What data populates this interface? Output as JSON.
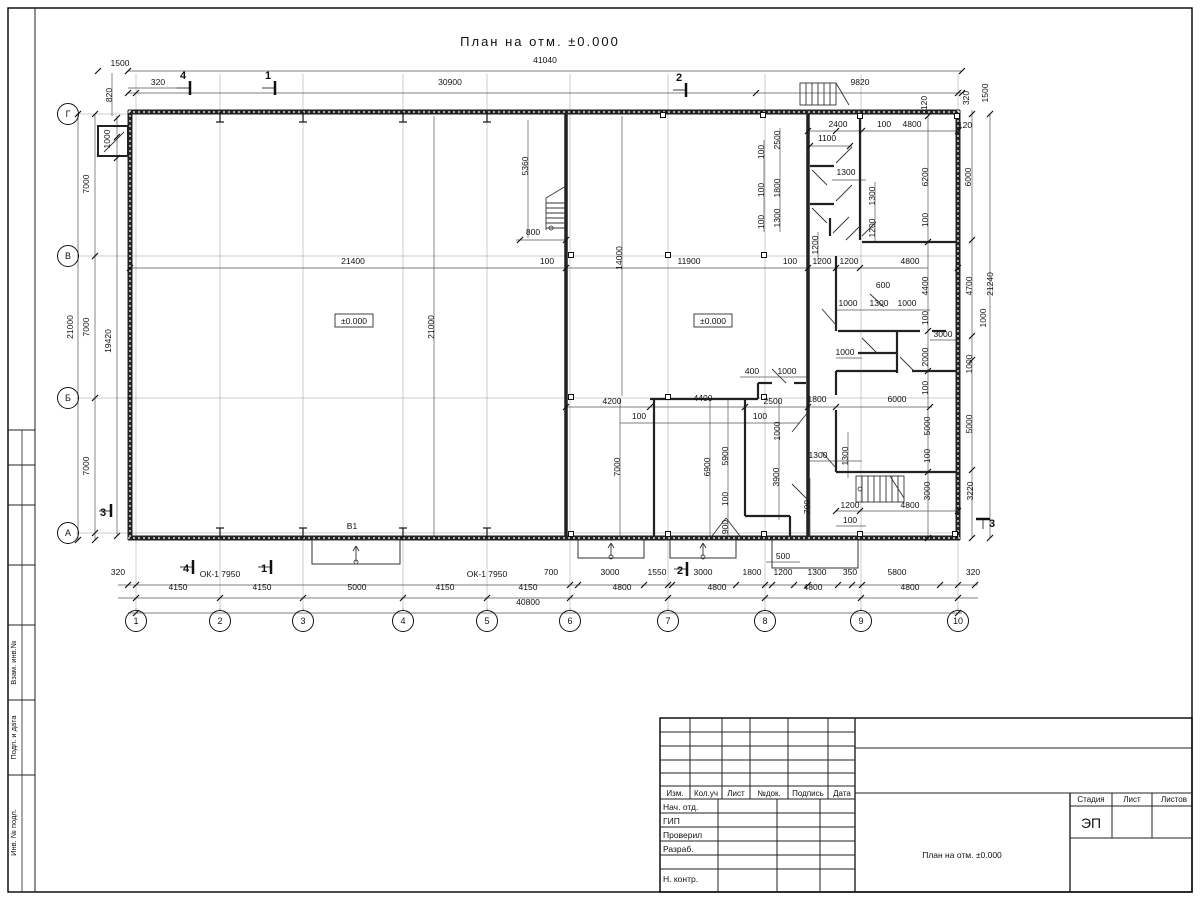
{
  "sheet": {
    "title": "План на отм. ±0.000"
  },
  "level_marks": [
    {
      "t": "±0.000",
      "x": 354,
      "y": 324
    },
    {
      "t": "±0.000",
      "x": 713,
      "y": 324
    }
  ],
  "labels": [
    {
      "t": "В1",
      "x": 352,
      "y": 529
    },
    {
      "t": "ОК-1 7950",
      "x": 220,
      "y": 577
    },
    {
      "t": "ОК-1 7950",
      "x": 487,
      "y": 577
    }
  ],
  "section_marks": [
    {
      "t": "4",
      "x": 183,
      "y": 79,
      "o": "t"
    },
    {
      "t": "1",
      "x": 268,
      "y": 79,
      "o": "t"
    },
    {
      "t": "2",
      "x": 679,
      "y": 81,
      "o": "t"
    },
    {
      "t": "4",
      "x": 186,
      "y": 572,
      "o": "b"
    },
    {
      "t": "1",
      "x": 264,
      "y": 572,
      "o": "b"
    },
    {
      "t": "2",
      "x": 680,
      "y": 574,
      "o": "b"
    },
    {
      "t": "3",
      "x": 103,
      "y": 516,
      "o": "l"
    },
    {
      "t": "3",
      "x": 992,
      "y": 527,
      "o": "r"
    }
  ],
  "grid": {
    "columns": [
      {
        "label": "1",
        "x": 136
      },
      {
        "label": "2",
        "x": 220
      },
      {
        "label": "3",
        "x": 303
      },
      {
        "label": "4",
        "x": 403
      },
      {
        "label": "5",
        "x": 487
      },
      {
        "label": "6",
        "x": 570
      },
      {
        "label": "7",
        "x": 668
      },
      {
        "label": "8",
        "x": 765
      },
      {
        "label": "9",
        "x": 861
      },
      {
        "label": "10",
        "x": 958
      }
    ],
    "bubble_y": 621,
    "rows": [
      {
        "label": "Г",
        "y": 114
      },
      {
        "label": "В",
        "y": 256
      },
      {
        "label": "Б",
        "y": 398
      },
      {
        "label": "А",
        "y": 533
      }
    ],
    "bubble_x": 68
  },
  "dims": [
    {
      "t": "41040",
      "x": 545,
      "y": 63
    },
    {
      "t": "30900",
      "x": 450,
      "y": 85
    },
    {
      "t": "9820",
      "x": 860,
      "y": 85
    },
    {
      "t": "1500",
      "x": 120,
      "y": 66
    },
    {
      "t": "320",
      "x": 158,
      "y": 85
    },
    {
      "t": "820",
      "x": 112,
      "y": 95,
      "v": 1
    },
    {
      "t": "120",
      "x": 927,
      "y": 103,
      "v": 1
    },
    {
      "t": "320",
      "x": 969,
      "y": 98,
      "v": 1
    },
    {
      "t": "1500",
      "x": 988,
      "y": 93,
      "v": 1
    },
    {
      "t": "1000",
      "x": 110,
      "y": 139,
      "v": 1
    },
    {
      "t": "7000",
      "x": 89,
      "y": 184,
      "v": 1
    },
    {
      "t": "7000",
      "x": 89,
      "y": 327,
      "v": 1
    },
    {
      "t": "7000",
      "x": 89,
      "y": 466,
      "v": 1
    },
    {
      "t": "21000",
      "x": 73,
      "y": 327,
      "v": 1
    },
    {
      "t": "19420",
      "x": 111,
      "y": 341,
      "v": 1
    },
    {
      "t": "21400",
      "x": 353,
      "y": 264
    },
    {
      "t": "100",
      "x": 547,
      "y": 264
    },
    {
      "t": "11900",
      "x": 689,
      "y": 264
    },
    {
      "t": "100",
      "x": 790,
      "y": 264
    },
    {
      "t": "1200",
      "x": 822,
      "y": 264
    },
    {
      "t": "1200",
      "x": 849,
      "y": 264
    },
    {
      "t": "4800",
      "x": 910,
      "y": 264
    },
    {
      "t": "800",
      "x": 533,
      "y": 235
    },
    {
      "t": "5360",
      "x": 528,
      "y": 166,
      "v": 1
    },
    {
      "t": "21000",
      "x": 434,
      "y": 327,
      "v": 1
    },
    {
      "t": "14000",
      "x": 622,
      "y": 258,
      "v": 1
    },
    {
      "t": "2400",
      "x": 838,
      "y": 127
    },
    {
      "t": "100",
      "x": 884,
      "y": 127
    },
    {
      "t": "4800",
      "x": 912,
      "y": 127
    },
    {
      "t": "120",
      "x": 965,
      "y": 128
    },
    {
      "t": "1100",
      "x": 827,
      "y": 141
    },
    {
      "t": "2500",
      "x": 780,
      "y": 140,
      "v": 1
    },
    {
      "t": "100",
      "x": 764,
      "y": 152,
      "v": 1
    },
    {
      "t": "1800",
      "x": 780,
      "y": 188,
      "v": 1
    },
    {
      "t": "100",
      "x": 764,
      "y": 190,
      "v": 1
    },
    {
      "t": "1300",
      "x": 780,
      "y": 218,
      "v": 1
    },
    {
      "t": "100",
      "x": 764,
      "y": 222,
      "v": 1
    },
    {
      "t": "1300",
      "x": 846,
      "y": 175
    },
    {
      "t": "1300",
      "x": 875,
      "y": 196,
      "v": 1
    },
    {
      "t": "1200",
      "x": 875,
      "y": 228,
      "v": 1
    },
    {
      "t": "1200",
      "x": 818,
      "y": 245,
      "v": 1
    },
    {
      "t": "6200",
      "x": 928,
      "y": 177,
      "v": 1
    },
    {
      "t": "6000",
      "x": 971,
      "y": 177,
      "v": 1
    },
    {
      "t": "100",
      "x": 928,
      "y": 220,
      "v": 1
    },
    {
      "t": "600",
      "x": 883,
      "y": 288
    },
    {
      "t": "1000",
      "x": 848,
      "y": 306
    },
    {
      "t": "1300",
      "x": 879,
      "y": 306
    },
    {
      "t": "1000",
      "x": 907,
      "y": 306
    },
    {
      "t": "100",
      "x": 928,
      "y": 318,
      "v": 1
    },
    {
      "t": "1000",
      "x": 986,
      "y": 318,
      "v": 1
    },
    {
      "t": "4400",
      "x": 928,
      "y": 286,
      "v": 1
    },
    {
      "t": "4700",
      "x": 972,
      "y": 286,
      "v": 1
    },
    {
      "t": "21240",
      "x": 993,
      "y": 284,
      "v": 1
    },
    {
      "t": "3000",
      "x": 943,
      "y": 337
    },
    {
      "t": "2000",
      "x": 928,
      "y": 357,
      "v": 1
    },
    {
      "t": "1000",
      "x": 845,
      "y": 355
    },
    {
      "t": "1000",
      "x": 972,
      "y": 364,
      "v": 1
    },
    {
      "t": "100",
      "x": 928,
      "y": 388,
      "v": 1
    },
    {
      "t": "400",
      "x": 752,
      "y": 374
    },
    {
      "t": "1000",
      "x": 787,
      "y": 374
    },
    {
      "t": "4200",
      "x": 612,
      "y": 404
    },
    {
      "t": "4400",
      "x": 703,
      "y": 401
    },
    {
      "t": "2500",
      "x": 773,
      "y": 404
    },
    {
      "t": "1800",
      "x": 817,
      "y": 402
    },
    {
      "t": "6000",
      "x": 897,
      "y": 402
    },
    {
      "t": "100",
      "x": 639,
      "y": 419
    },
    {
      "t": "100",
      "x": 760,
      "y": 419
    },
    {
      "t": "1000",
      "x": 780,
      "y": 431,
      "v": 1
    },
    {
      "t": "7000",
      "x": 620,
      "y": 467,
      "v": 1
    },
    {
      "t": "6900",
      "x": 710,
      "y": 467,
      "v": 1
    },
    {
      "t": "5900",
      "x": 728,
      "y": 456,
      "v": 1
    },
    {
      "t": "3900",
      "x": 779,
      "y": 477,
      "v": 1
    },
    {
      "t": "5000",
      "x": 930,
      "y": 426,
      "v": 1
    },
    {
      "t": "5000",
      "x": 972,
      "y": 424,
      "v": 1
    },
    {
      "t": "1300",
      "x": 818,
      "y": 458
    },
    {
      "t": "1300",
      "x": 848,
      "y": 456,
      "v": 1
    },
    {
      "t": "100",
      "x": 930,
      "y": 456,
      "v": 1
    },
    {
      "t": "700",
      "x": 810,
      "y": 507,
      "v": 1
    },
    {
      "t": "100",
      "x": 728,
      "y": 499,
      "v": 1
    },
    {
      "t": "900",
      "x": 728,
      "y": 527,
      "v": 1
    },
    {
      "t": "3000",
      "x": 930,
      "y": 491,
      "v": 1
    },
    {
      "t": "3220",
      "x": 973,
      "y": 491,
      "v": 1
    },
    {
      "t": "1200",
      "x": 850,
      "y": 508
    },
    {
      "t": "4800",
      "x": 910,
      "y": 508
    },
    {
      "t": "100",
      "x": 850,
      "y": 523
    },
    {
      "t": "500",
      "x": 783,
      "y": 559
    },
    {
      "t": "320",
      "x": 118,
      "y": 575
    },
    {
      "t": "700",
      "x": 551,
      "y": 575
    },
    {
      "t": "3000",
      "x": 610,
      "y": 575
    },
    {
      "t": "1550",
      "x": 657,
      "y": 575
    },
    {
      "t": "3000",
      "x": 703,
      "y": 575
    },
    {
      "t": "1800",
      "x": 752,
      "y": 575
    },
    {
      "t": "1200",
      "x": 783,
      "y": 575
    },
    {
      "t": "1300",
      "x": 817,
      "y": 575
    },
    {
      "t": "350",
      "x": 850,
      "y": 575
    },
    {
      "t": "5800",
      "x": 897,
      "y": 575
    },
    {
      "t": "320",
      "x": 973,
      "y": 575
    },
    {
      "t": "4150",
      "x": 178,
      "y": 590
    },
    {
      "t": "4150",
      "x": 262,
      "y": 590
    },
    {
      "t": "5000",
      "x": 357,
      "y": 590
    },
    {
      "t": "4150",
      "x": 445,
      "y": 590
    },
    {
      "t": "4150",
      "x": 528,
      "y": 590
    },
    {
      "t": "4800",
      "x": 622,
      "y": 590
    },
    {
      "t": "4800",
      "x": 717,
      "y": 590
    },
    {
      "t": "4800",
      "x": 813,
      "y": 590
    },
    {
      "t": "4800",
      "x": 910,
      "y": 590
    },
    {
      "t": "40800",
      "x": 528,
      "y": 605
    }
  ],
  "title_block": {
    "header_cols": [
      "Изм.",
      "Кол.уч",
      "Лист",
      "№док.",
      "Подпись",
      "Дата"
    ],
    "rows": [
      "Нач. отд.",
      "ГИП",
      "Проверил",
      "Разраб.",
      "",
      "Н. контр."
    ],
    "stage_label": "Стадия",
    "sheet_label": "Лист",
    "sheets_label": "Листов",
    "stage_value": "ЭП",
    "doc_title": "План на отм. ±0.000"
  },
  "side_stamps": [
    "Взам. инв.№",
    "Подп. и дата",
    "Инв. № подл."
  ]
}
